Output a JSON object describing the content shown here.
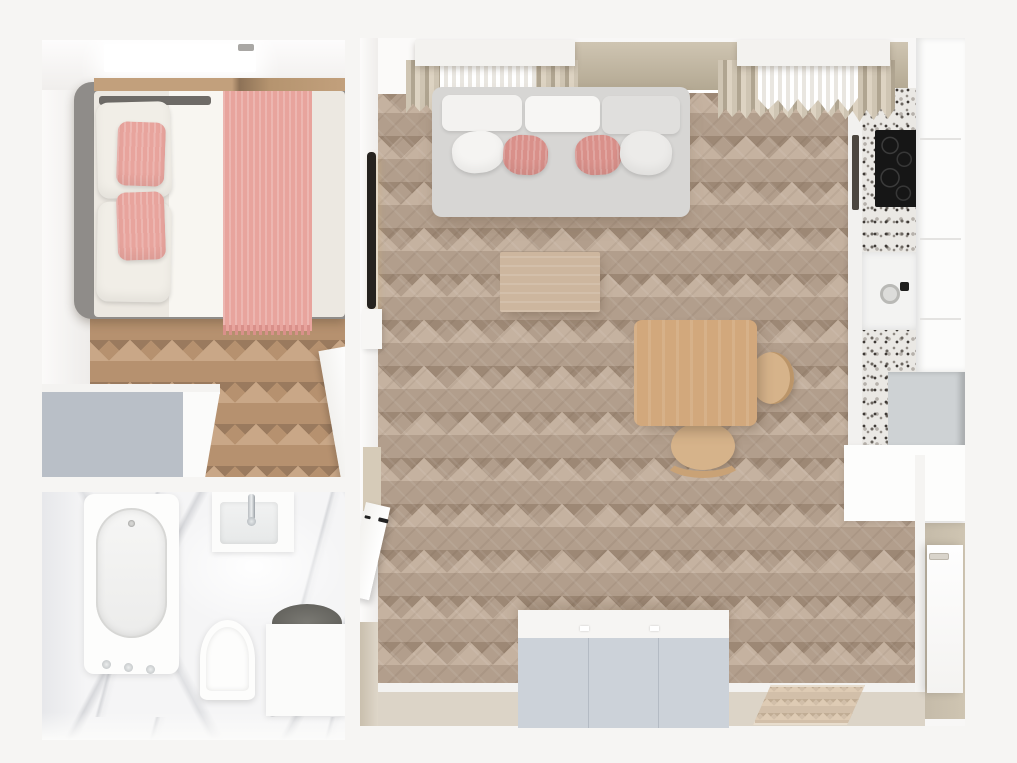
{
  "view": {
    "type": "apartment-3d-floor-plan-top-view",
    "rooms": {
      "bedroom": {
        "name": "bedroom",
        "objects": [
          "skylight-window",
          "double-bed",
          "gray-bed-frame",
          "white-pillows",
          "pink-pillows",
          "white-duvet",
          "pink-throw-runner",
          "wardrobe",
          "open-door",
          "herringbone-wood-floor"
        ]
      },
      "bathroom": {
        "name": "bathroom",
        "objects": [
          "bathtub",
          "tub-faucet-knobs",
          "washbasin",
          "chrome-faucet",
          "toilet",
          "laundry-basket-unit",
          "marble-floor"
        ]
      },
      "living_room": {
        "name": "living-room-with-kitchenette",
        "objects": [
          "two-windows-with-curtains",
          "sofa",
          "back-cushions",
          "pink-cushions",
          "coffee-table",
          "dining-table",
          "two-wood-chairs",
          "wall-tv",
          "sideboard-wardrobe",
          "doormat-rug",
          "entrance-door",
          "hallway-door",
          "herringbone-wood-floor",
          "entry-floor"
        ]
      },
      "kitchen": {
        "name": "kitchenette",
        "objects": [
          "terrazzo-counter",
          "induction-cooktop",
          "oven-handle",
          "kitchen-sink",
          "black-faucet",
          "tall-white-cabinets",
          "fridge-top",
          "corner-cabinet"
        ]
      }
    }
  },
  "palette": {
    "bg": "#f6f5f3",
    "wall_white": "#fafaf9",
    "wall_beige": "#cfc5b2",
    "wall_beige_dark": "#b2a791",
    "floor_living_mid": "#b29e8c",
    "floor_living_light": "#c5b2a0",
    "floor_living_dark": "#9d8875",
    "floor_bedroom_mid": "#b6916f",
    "floor_bedroom_light": "#c9a787",
    "floor_bedroom_dark": "#9a7a5e",
    "bed_frame": "#8f8c89",
    "headboard_dark": "#6e6b67",
    "bed_shelf_wood": "#c2a07c",
    "duvet": "#ece8e1",
    "sheet_white": "#f8f6f1",
    "pillow_cream": "#f1eee7",
    "pink": "#e8a49d",
    "pink_deep": "#d9908a",
    "wardrobe_gray": "#b9bfc7",
    "white_panel": "#fcfcfb",
    "marble": "#f5f5f6",
    "sofa_body": "#d7d6d4",
    "cushion_white": "#f3f2f0",
    "cushion_gray": "#e0dfdd",
    "coffee_wood": "#cdb69e",
    "dining_wood": "#d2a87c",
    "chair_wood": "#d6b38a",
    "terrazzo_base": "#eae8e4",
    "cooktop_black": "#161616",
    "oven_dark": "#4c463f",
    "fridge_gray": "#ced2d4",
    "sink_white": "#f3f3f2",
    "entry_floor": "#dcd4c7",
    "rug": "#d2bfa9",
    "wardrobe_front": "#ccd2d9",
    "door_white": "#fdfdfc",
    "tv_black": "#26231f",
    "washer_dark": "#6b6a66",
    "curtain_beige": "#cfc5b3"
  }
}
